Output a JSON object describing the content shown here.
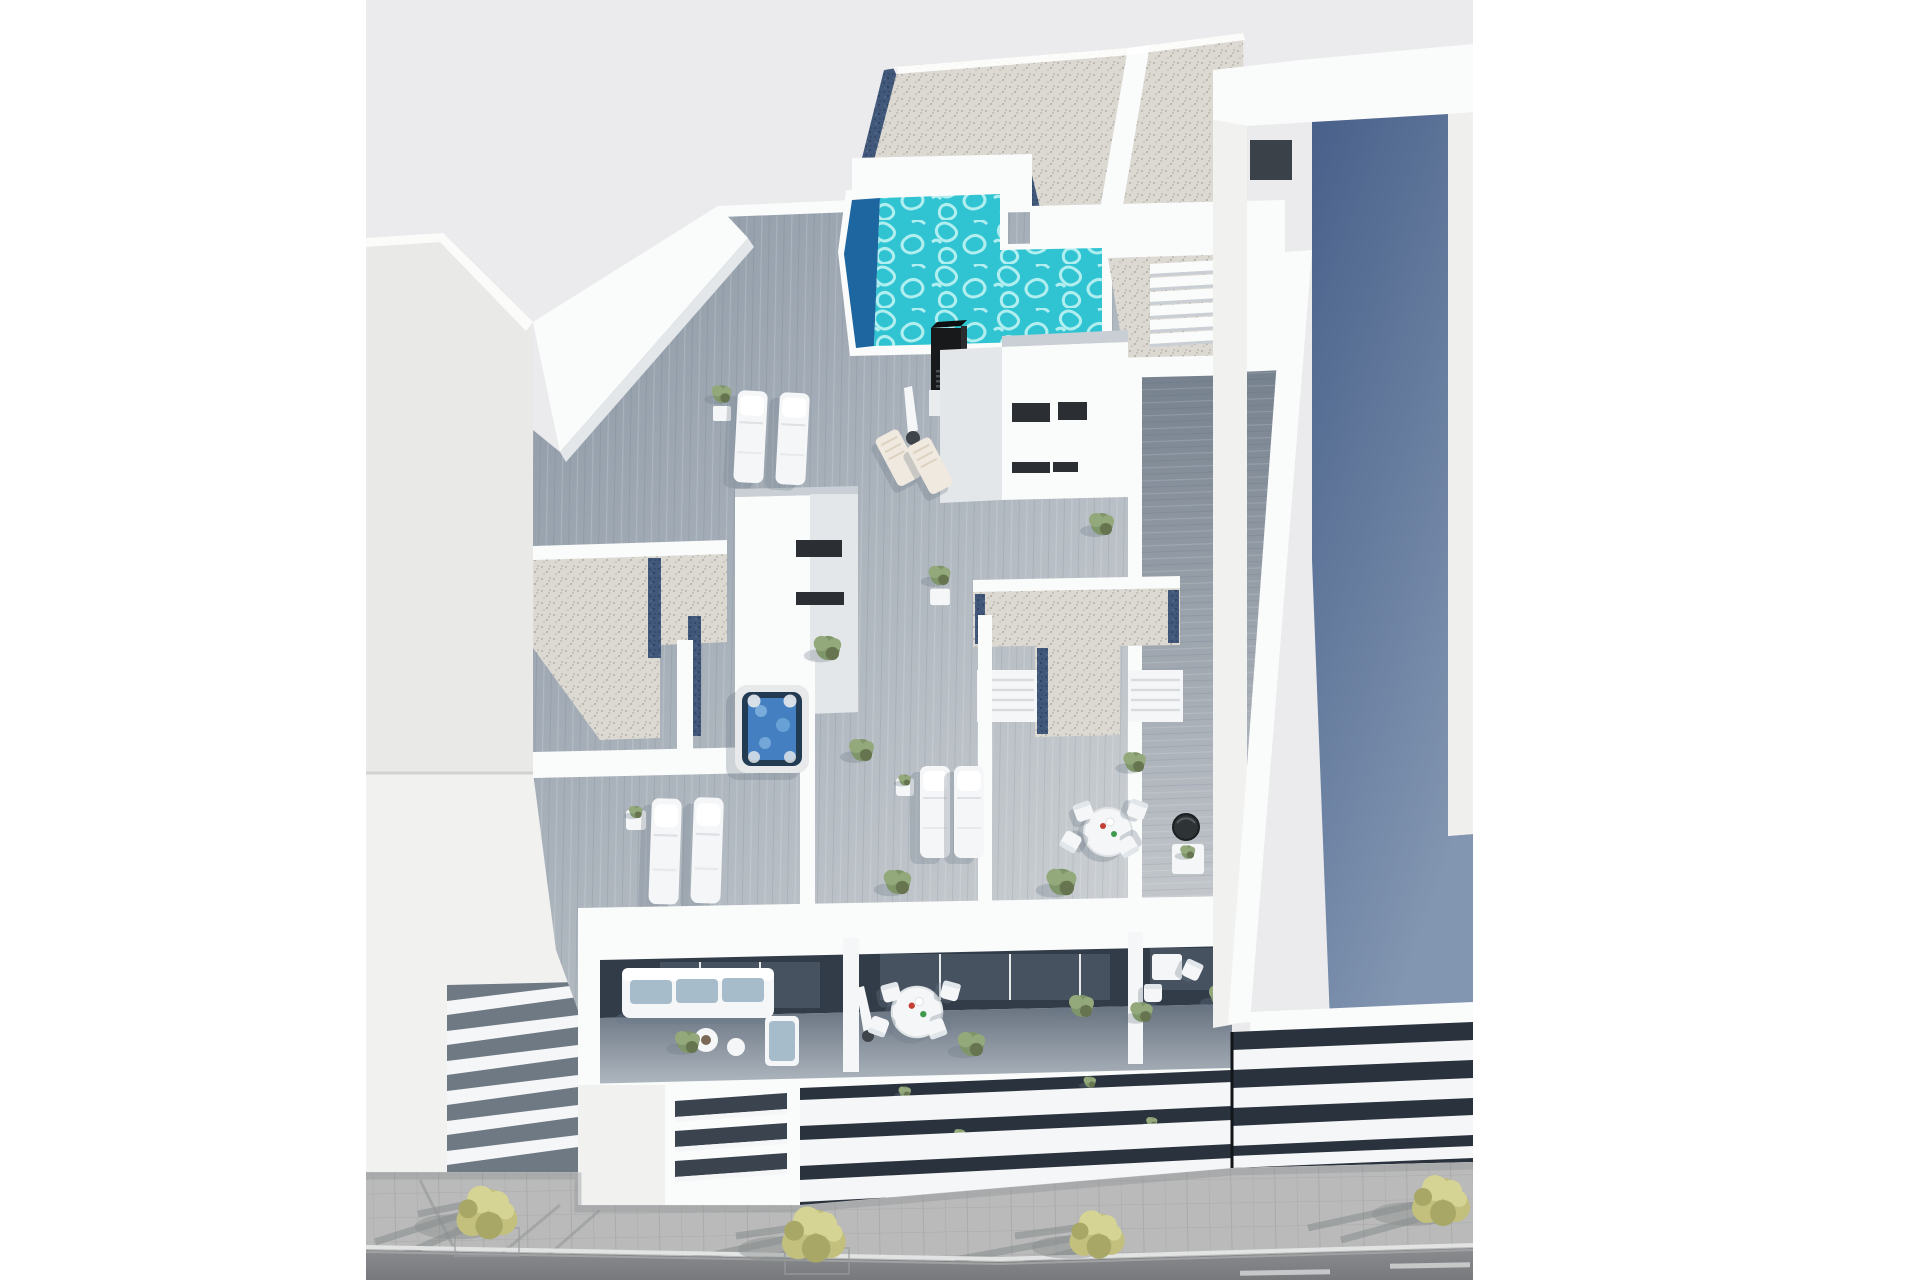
{
  "colors": {
    "page_bg": "#ffffff",
    "sky": "#ebebed",
    "left_building": "#e9e9e7",
    "left_building_lower": "#f1f1f0",
    "white_wall": "#fafbfb",
    "wall_shade": "#e4e7ea",
    "wall_dark": "#c9cfd5",
    "window_dark": "#2b2e33",
    "deck_dark": "#8a96a4",
    "deck_light": "#cdd1d4",
    "walkway_dark": "#76818e",
    "walkway_light": "#d3d6d9",
    "gravel": "#dcd9d3",
    "gravel_dot": "#b5b1a9",
    "gravel_blue": "#42587a",
    "gravel_blue_dot": "#2c3e5a",
    "pool_bright": "#30c4d3",
    "pool_caustic": "#c8f6f5",
    "pool_deep": "#1e66a0",
    "chimney_dark": "#18191b",
    "chimney_grille": "#4a4e52",
    "jacuzzi_rim": "#e7e9eb",
    "jacuzzi_dark": "#223a52",
    "jacuzzi_water": "#4480c1",
    "furniture_white": "#f5f6f7",
    "deckchair_cream": "#efe9df",
    "sofa_cushion": "#a7bccb",
    "interior_dark": "#323c49",
    "glass_dark": "#46525f",
    "facade_dark": "#2a323d",
    "roof_blue_top": "#48608a",
    "roof_blue_bottom": "#8296b1",
    "sidewalk": "#b9bab9",
    "curb_white": "#e2e3e3",
    "road_top": "#8a8c8f",
    "road_bottom": "#77797c",
    "floor_dark": "#66717f",
    "floor_light": "#b0b8c0",
    "tree_yellow": "#c2c07c",
    "tree_yellow_light": "#d6d494",
    "tree_yellow_dark": "#a8a765",
    "tree_shadow": "#8a8d8f",
    "bush_green": "#7f956a",
    "bush_green_light": "#93a87b",
    "bush_green_dark": "#66744f",
    "shadow_soft": "#6d7a89"
  },
  "scene": {
    "elements": [
      "sky",
      "left-building",
      "louvered-facade",
      "main-building",
      "gravel-roof",
      "rooftop-pool",
      "pool-stairs",
      "ventilation-chimney",
      "stairwell-box",
      "roof-terraces",
      "sun-loungers",
      "deck-chairs",
      "parasol",
      "jacuzzi",
      "potted-plants",
      "dining-set",
      "bbq-grill",
      "side-walkway",
      "parapet-wall",
      "balcony-level",
      "sofa-set",
      "daybed",
      "coffee-tables",
      "slab-facade",
      "right-building",
      "blue-flat-roof",
      "street",
      "sidewalk",
      "kerb",
      "road",
      "street-trees"
    ]
  }
}
